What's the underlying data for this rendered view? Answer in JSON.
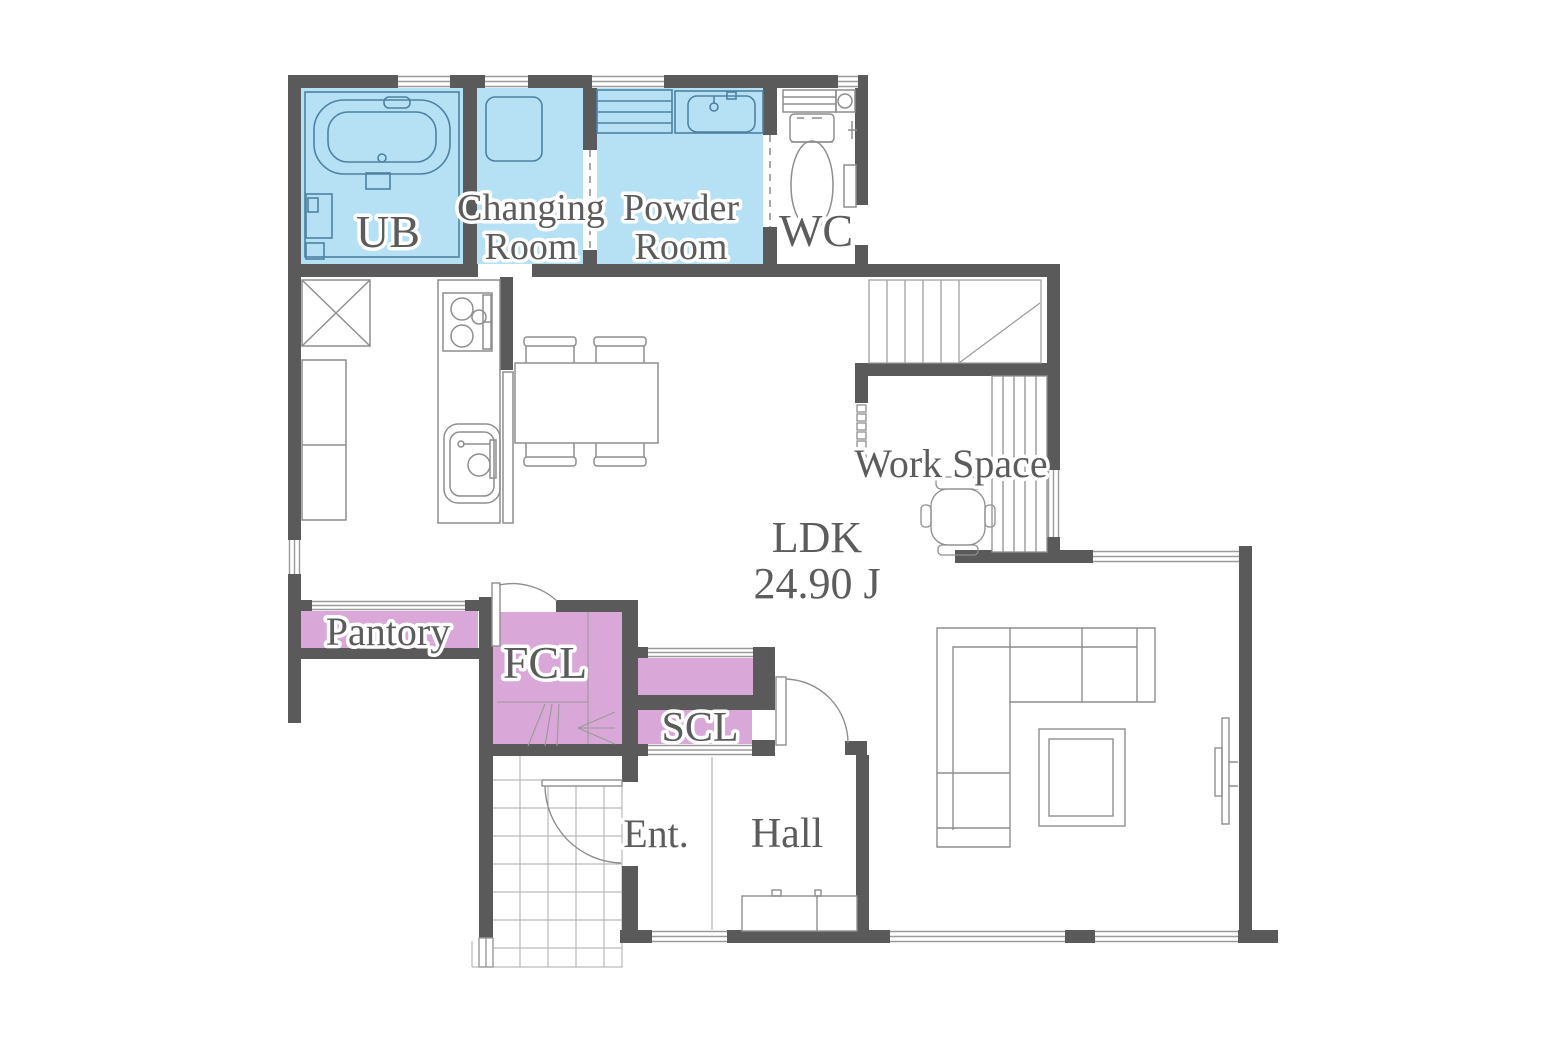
{
  "title": "1F Floor Plan",
  "colors": {
    "wall": "#5A5A5A",
    "wet_area": "#B6E0F4",
    "storage_area": "#D9A7D8",
    "furniture_line": "#8E8E8E",
    "bath_line": "#4E82A2",
    "window_line": "#9A9A9A",
    "tile_line": "#ABABAB",
    "text": "#5C5C5C"
  },
  "rooms": {
    "ub": "UB",
    "changing_line1": "Changing",
    "changing_line2": "Room",
    "powder_line1": "Powder",
    "powder_line2": "Room",
    "wc": "WC",
    "work_space": "Work Space",
    "ldk_name": "LDK",
    "ldk_area": "24.90 J",
    "pantry": "Pantory",
    "fcl": "FCL",
    "scl": "SCL",
    "entrance": "Ent.",
    "hall": "Hall"
  }
}
